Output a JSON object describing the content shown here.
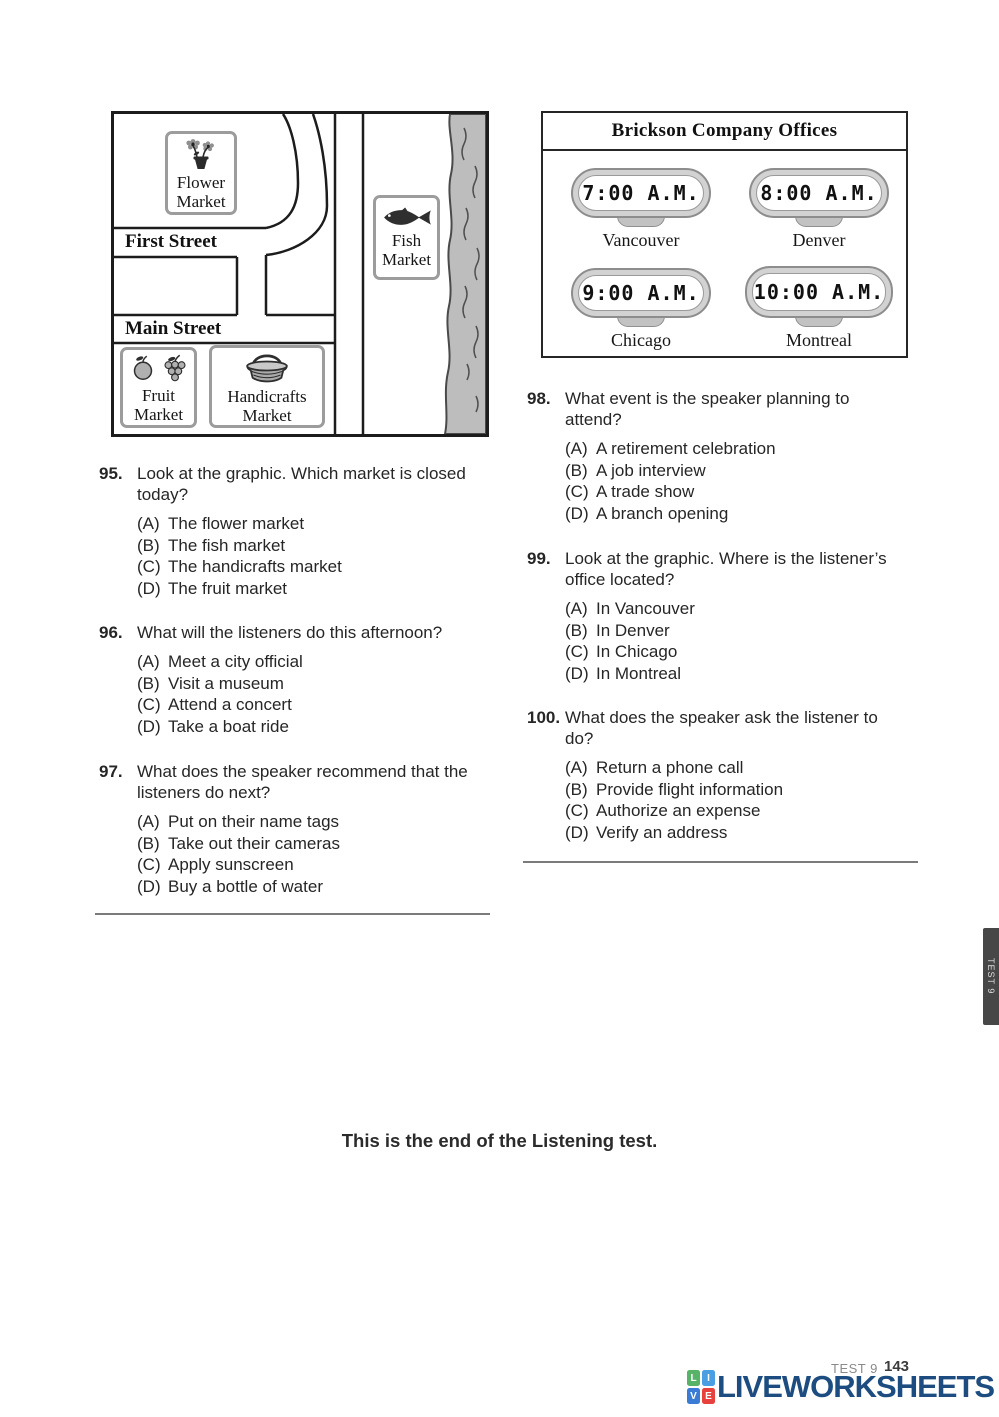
{
  "page": {
    "end_of_test": "This is the end of the Listening test.",
    "side_tab_label": "TEST 9",
    "footer": {
      "test_label": "TEST 9",
      "page_number": "143",
      "brand": "LIVEWORKSHEETS",
      "brand_grid": {
        "tl": "L",
        "tr": "I",
        "bl": "V",
        "br": "E"
      }
    }
  },
  "map": {
    "streets": {
      "first": "First Street",
      "main": "Main Street"
    },
    "signs": {
      "flower": {
        "line1": "Flower",
        "line2": "Market"
      },
      "fish": {
        "line1": "Fish",
        "line2": "Market"
      },
      "fruit": {
        "line1": "Fruit",
        "line2": "Market"
      },
      "handicrafts": {
        "line1": "Handicrafts",
        "line2": "Market"
      }
    }
  },
  "offices": {
    "title": "Brickson Company Offices",
    "clocks": [
      {
        "time": "7:00 A.M.",
        "city": "Vancouver"
      },
      {
        "time": "8:00 A.M.",
        "city": "Denver"
      },
      {
        "time": "9:00 A.M.",
        "city": "Chicago"
      },
      {
        "time": "10:00 A.M.",
        "city": "Montreal"
      }
    ]
  },
  "questions": [
    {
      "number": "95.",
      "text": "Look at the graphic. Which market is closed today?",
      "options": [
        {
          "label": "(A)",
          "text": "The flower market"
        },
        {
          "label": "(B)",
          "text": "The fish market"
        },
        {
          "label": "(C)",
          "text": "The handicrafts market"
        },
        {
          "label": "(D)",
          "text": "The fruit market"
        }
      ]
    },
    {
      "number": "96.",
      "text": "What will the listeners do this afternoon?",
      "options": [
        {
          "label": "(A)",
          "text": "Meet a city official"
        },
        {
          "label": "(B)",
          "text": "Visit a museum"
        },
        {
          "label": "(C)",
          "text": "Attend a concert"
        },
        {
          "label": "(D)",
          "text": "Take a boat ride"
        }
      ]
    },
    {
      "number": "97.",
      "text": "What does the speaker recommend that the listeners do next?",
      "options": [
        {
          "label": "(A)",
          "text": "Put on their name tags"
        },
        {
          "label": "(B)",
          "text": "Take out their cameras"
        },
        {
          "label": "(C)",
          "text": "Apply sunscreen"
        },
        {
          "label": "(D)",
          "text": "Buy a bottle of water"
        }
      ]
    },
    {
      "number": "98.",
      "text": "What event is the speaker planning to attend?",
      "options": [
        {
          "label": "(A)",
          "text": "A retirement celebration"
        },
        {
          "label": "(B)",
          "text": "A job interview"
        },
        {
          "label": "(C)",
          "text": "A trade show"
        },
        {
          "label": "(D)",
          "text": "A branch opening"
        }
      ]
    },
    {
      "number": "99.",
      "text": "Look at the graphic. Where is the listener’s office located?",
      "options": [
        {
          "label": "(A)",
          "text": "In Vancouver"
        },
        {
          "label": "(B)",
          "text": "In Denver"
        },
        {
          "label": "(C)",
          "text": "In Chicago"
        },
        {
          "label": "(D)",
          "text": "In Montreal"
        }
      ]
    },
    {
      "number": "100.",
      "text": "What does the speaker ask the listener to do?",
      "options": [
        {
          "label": "(A)",
          "text": "Return a phone call"
        },
        {
          "label": "(B)",
          "text": "Provide flight information"
        },
        {
          "label": "(C)",
          "text": "Authorize an expense"
        },
        {
          "label": "(D)",
          "text": "Verify an address"
        }
      ]
    }
  ],
  "colors": {
    "logo_navy": "#1d4d80",
    "grid_green": "#58b368",
    "grid_blue": "#4a9fe3",
    "grid_blue2": "#3a7bd5",
    "grid_red": "#e6413d",
    "river_gray": "#bdbdbd"
  }
}
